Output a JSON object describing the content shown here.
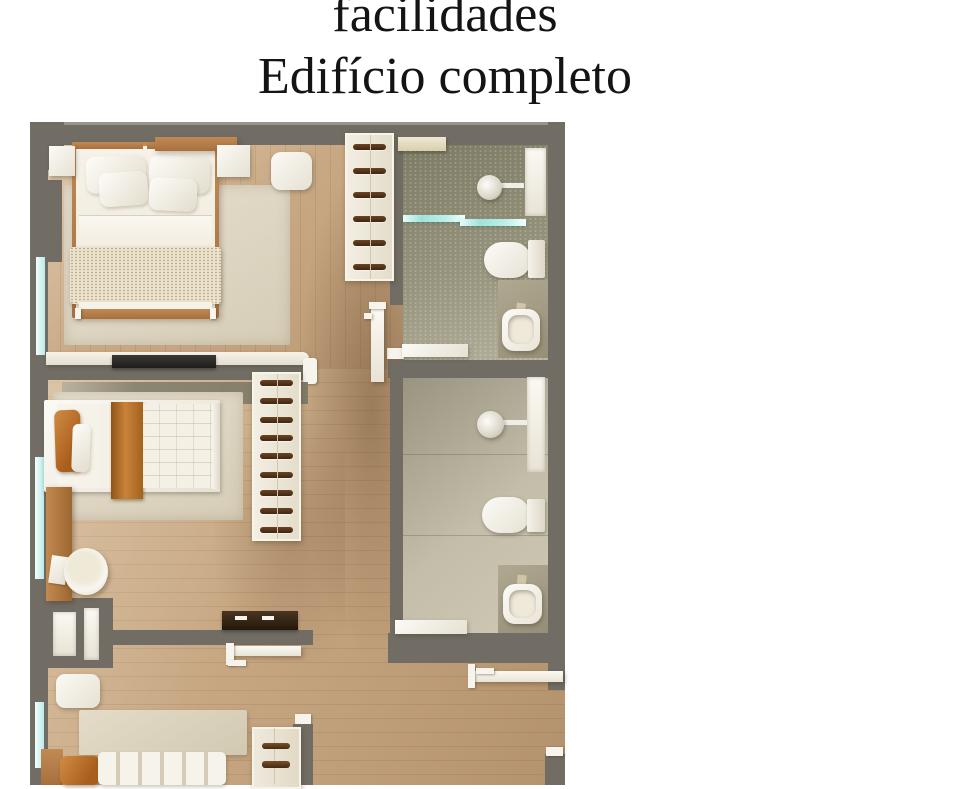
{
  "title": {
    "line1": "facilidades",
    "line2": "Edifício completo"
  },
  "palette": {
    "background": "#ffffff",
    "title_text": "#141414",
    "wall": "#716d64",
    "wood_floor": "#c9a984",
    "rug_beige": "#e0d9c6",
    "accent_orange": "#b96f2d",
    "furniture_wood": "#b5814e",
    "bathroom_tile_green": "#8e8c77",
    "bathroom_tile_beige": "#c5bfab",
    "glass_teal": "#aee8e4",
    "fixture_white": "#f5f3ec",
    "dark_furniture": "#3a2a1b"
  }
}
